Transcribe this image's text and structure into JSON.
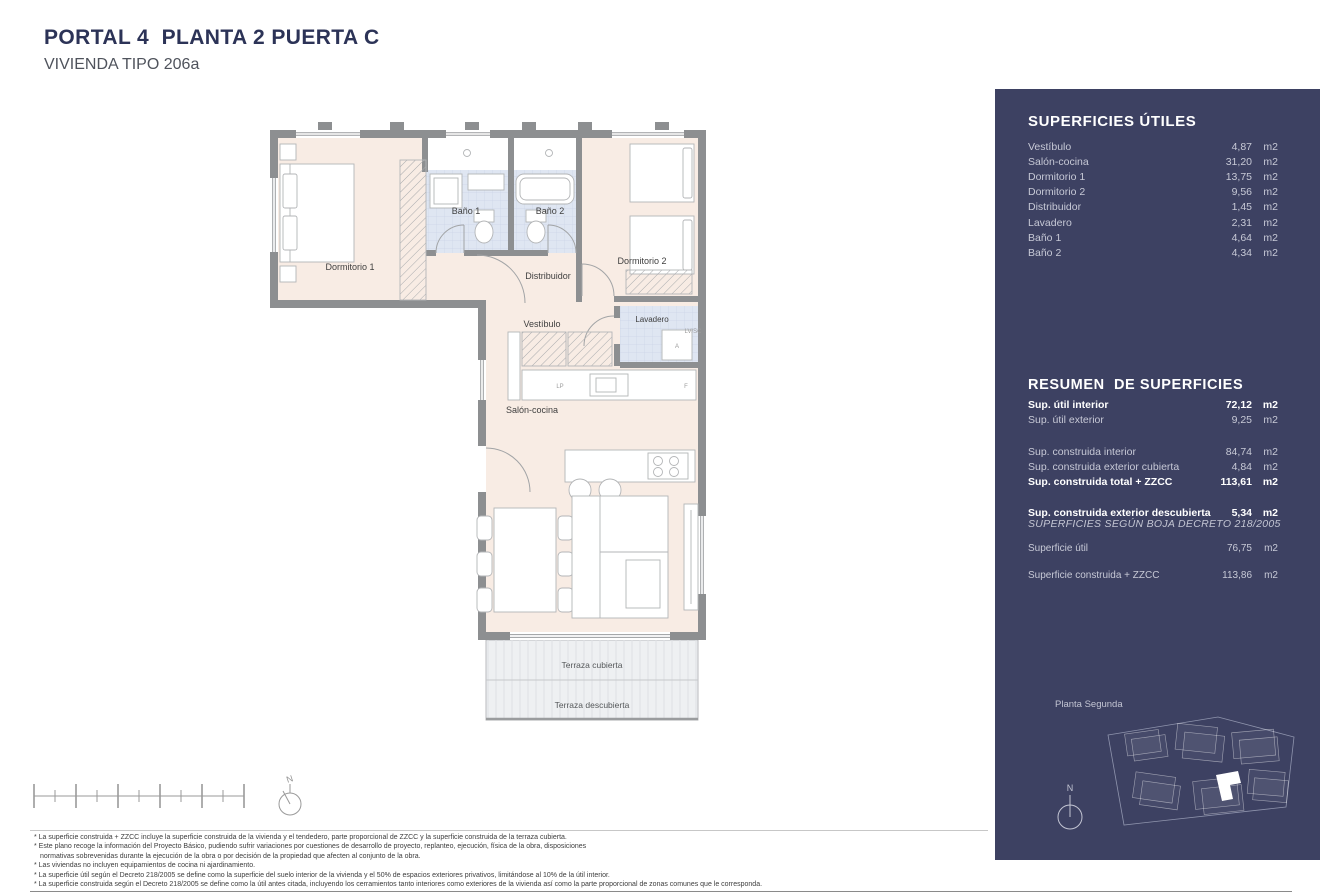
{
  "header": {
    "title": "PORTAL 4  PLANTA 2 PUERTA C",
    "subtitle": "VIVIENDA TIPO 206a"
  },
  "colors": {
    "panel_bg": "#3D4162",
    "title_navy": "#2C3357",
    "floor_cream": "#F8ECE4",
    "bath_tile": "#DFE6F2",
    "wall_gray": "#8D8F91"
  },
  "plan": {
    "labels": {
      "dormitorio1": "Dormitorio 1",
      "bano1": "Baño 1",
      "bano2": "Baño 2",
      "dormitorio2": "Dormitorio 2",
      "distribuidor": "Distribuidor",
      "vestibulo": "Vestíbulo",
      "lavadero": "Lavadero",
      "lvsc": "LV/SC",
      "appliance_a": "A",
      "lp": "LP",
      "f": "F",
      "salon": "Salón-cocina",
      "terraza_cubierta": "Terraza cubierta",
      "terraza_descubierta": "Terraza descubierta"
    }
  },
  "panel": {
    "unit": "m2",
    "superficies_utiles": {
      "title": "SUPERFICIES ÚTILES",
      "rows": [
        {
          "label": "Vestíbulo",
          "value": "4,87"
        },
        {
          "label": "Salón-cocina",
          "value": "31,20"
        },
        {
          "label": "Dormitorio 1",
          "value": "13,75"
        },
        {
          "label": "Dormitorio 2",
          "value": "9,56"
        },
        {
          "label": "Distribuidor",
          "value": "1,45"
        },
        {
          "label": "Lavadero",
          "value": "2,31"
        },
        {
          "label": "Baño 1",
          "value": "4,64"
        },
        {
          "label": "Baño 2",
          "value": "4,34"
        }
      ]
    },
    "resumen": {
      "title": "RESUMEN  DE SUPERFICIES",
      "rows": [
        {
          "label": "Sup. útil interior",
          "value": "72,12",
          "bold": true
        },
        {
          "label": "Sup. útil exterior",
          "value": "9,25",
          "bold": false
        },
        {
          "label": "Sup. construida interior",
          "value": "84,74",
          "bold": false
        },
        {
          "label": "Sup. construida exterior cubierta",
          "value": "4,84",
          "bold": false
        },
        {
          "label": "Sup. construida total + ZZCC",
          "value": "113,61",
          "bold": true
        },
        {
          "label": "Sup. construida exterior descubierta",
          "value": "5,34",
          "bold": true
        }
      ]
    },
    "boja": {
      "title": "SUPERFICIES SEGÚN BOJA DECRETO 218/2005",
      "rows": [
        {
          "label": "Superficie útil",
          "value": "76,75"
        },
        {
          "label": "Superficie construida + ZZCC",
          "value": "113,86"
        }
      ]
    },
    "siteplan": {
      "label": "Planta Segunda",
      "north": "N"
    }
  },
  "compass": {
    "north": "N"
  },
  "footnotes": {
    "lines": [
      "* La superficie construida + ZZCC incluye la superficie construida de la vivienda y el tendedero, parte proporcional de ZZCC y la superficie construida de la terraza cubierta.",
      "* Este plano recoge la información del Proyecto Básico, pudiendo sufrir variaciones por cuestiones de desarrollo de proyecto, replanteo, ejecución, física de la obra, disposiciones",
      "normativas sobrevenidas durante la ejecución de la obra o por decisión de la propiedad que afecten al conjunto de la obra.",
      "* Las viviendas no incluyen equipamientos de cocina ni ajardinamiento.",
      "* La superficie útil según el Decreto 218/2005 se define como la superficie del suelo interior de la vivienda y el 50% de espacios exteriores privativos, limitándose al 10% de la útil interior.",
      "* La superficie construida según el Decreto 218/2005 se define como la útil antes citada, incluyendo los cerramientos tanto interiores como exteriores de la vivienda así como la parte proporcional de zonas comunes que le corresponda."
    ]
  }
}
